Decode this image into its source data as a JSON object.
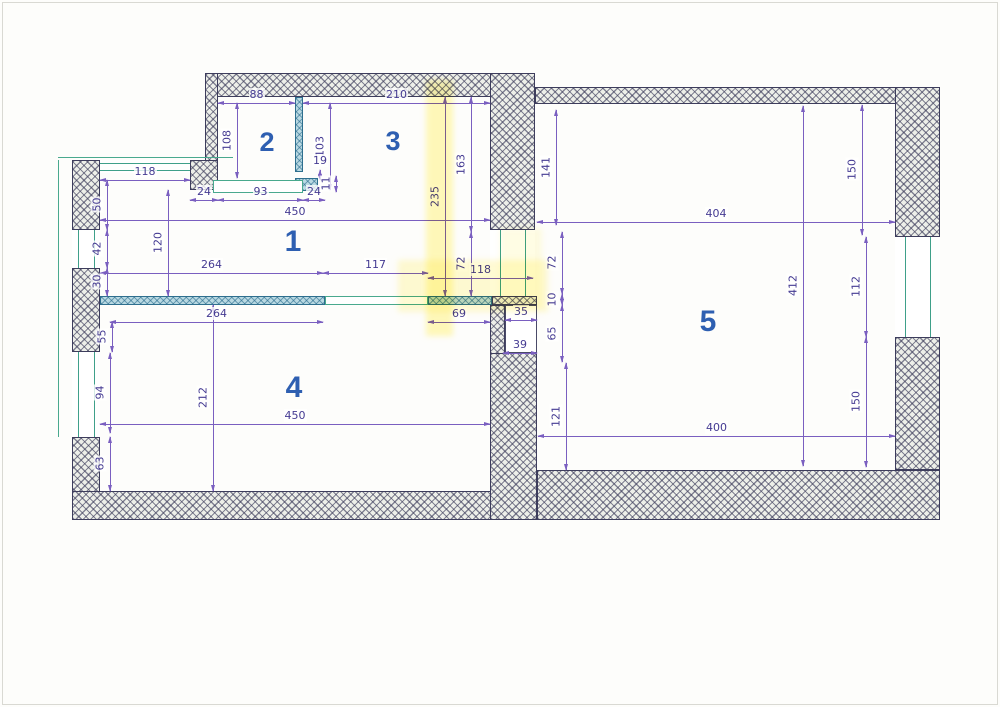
{
  "document": {
    "type": "scanned floor plan",
    "units": "cm"
  },
  "colors": {
    "page_bg": "#fdfdfb",
    "page_border": "#d9d9d3",
    "wall_hatch": "#3e3e5c",
    "wall_fill": "#edefe9",
    "partition_fill": "#b9d9e2",
    "partition_edge": "#2e6f8e",
    "window_green": "#3fa08a",
    "dim_line": "#7a5fc0",
    "dim_text": "#453b92",
    "room_number": "#2e5fb1",
    "highlighter": "#fff176"
  },
  "rooms": [
    {
      "n": "1",
      "x": 293,
      "y": 242,
      "s": 30
    },
    {
      "n": "2",
      "x": 267,
      "y": 142,
      "s": 27
    },
    {
      "n": "3",
      "x": 393,
      "y": 141,
      "s": 27
    },
    {
      "n": "4",
      "x": 294,
      "y": 388,
      "s": 30
    },
    {
      "n": "5",
      "x": 708,
      "y": 322,
      "s": 30
    }
  ],
  "walls": [
    {
      "x": 205,
      "y": 73,
      "w": 330,
      "h": 24
    },
    {
      "x": 205,
      "y": 73,
      "w": 13,
      "h": 107
    },
    {
      "x": 190,
      "y": 160,
      "w": 28,
      "h": 30
    },
    {
      "x": 490,
      "y": 73,
      "w": 45,
      "h": 157
    },
    {
      "x": 535,
      "y": 87,
      "w": 405,
      "h": 17
    },
    {
      "x": 895,
      "y": 87,
      "w": 45,
      "h": 150
    },
    {
      "x": 895,
      "y": 337,
      "w": 45,
      "h": 133
    },
    {
      "x": 537,
      "y": 470,
      "w": 403,
      "h": 50
    },
    {
      "x": 72,
      "y": 160,
      "w": 28,
      "h": 70
    },
    {
      "x": 72,
      "y": 268,
      "w": 28,
      "h": 84
    },
    {
      "x": 72,
      "y": 437,
      "w": 28,
      "h": 83
    },
    {
      "x": 72,
      "y": 491,
      "w": 465,
      "h": 29
    },
    {
      "x": 490,
      "y": 305,
      "w": 15,
      "h": 57
    },
    {
      "x": 490,
      "y": 353,
      "w": 47,
      "h": 167
    },
    {
      "x": 492,
      "y": 296,
      "w": 45,
      "h": 9
    },
    {
      "x": 295,
      "y": 97,
      "w": 8,
      "h": 75,
      "t": 1
    },
    {
      "x": 295,
      "y": 178,
      "w": 23,
      "h": 13,
      "t": 1
    },
    {
      "x": 100,
      "y": 296,
      "w": 225,
      "h": 9,
      "t": 1
    },
    {
      "x": 428,
      "y": 296,
      "w": 64,
      "h": 9,
      "t": 1
    }
  ],
  "windows": [
    {
      "x": 100,
      "y": 160,
      "w": 90,
      "h": 13,
      "k": "h"
    },
    {
      "x": 72,
      "y": 230,
      "w": 28,
      "h": 38,
      "k": "v"
    },
    {
      "x": 72,
      "y": 352,
      "w": 28,
      "h": 85,
      "k": "v"
    },
    {
      "x": 895,
      "y": 237,
      "w": 45,
      "h": 100,
      "k": "v"
    },
    {
      "x": 490,
      "y": 230,
      "w": 45,
      "h": 66,
      "k": "v"
    },
    {
      "x": 213,
      "y": 180,
      "w": 90,
      "h": 13,
      "k": "box"
    },
    {
      "x": 325,
      "y": 296,
      "w": 103,
      "h": 9,
      "k": "box"
    }
  ],
  "contours": [
    {
      "x": 58,
      "y": 160,
      "w": 1,
      "h": 277
    },
    {
      "x": 58,
      "y": 157,
      "w": 175,
      "h": 1
    }
  ],
  "niches": [
    {
      "x": 505,
      "y": 305,
      "w": 32,
      "h": 48
    }
  ],
  "highlights": [
    {
      "x": 426,
      "y": 80,
      "w": 27,
      "h": 256,
      "op": 0.5
    },
    {
      "x": 398,
      "y": 260,
      "w": 150,
      "h": 52,
      "op": 0.32
    },
    {
      "x": 500,
      "y": 228,
      "w": 42,
      "h": 80,
      "op": 0.2
    }
  ],
  "dims": [
    {
      "l": "88",
      "o": "h",
      "x": 218,
      "y": 103,
      "len": 77
    },
    {
      "l": "210",
      "o": "h",
      "x": 303,
      "y": 103,
      "len": 187
    },
    {
      "l": "118",
      "o": "h",
      "x": 100,
      "y": 180,
      "len": 90
    },
    {
      "l": "24",
      "o": "h",
      "x": 190,
      "y": 200,
      "len": 28
    },
    {
      "l": "93",
      "o": "h",
      "x": 218,
      "y": 200,
      "len": 85
    },
    {
      "l": "24",
      "o": "h",
      "x": 303,
      "y": 200,
      "len": 22
    },
    {
      "l": "450",
      "o": "h",
      "x": 100,
      "y": 220,
      "len": 390
    },
    {
      "l": "264",
      "o": "h",
      "x": 100,
      "y": 273,
      "len": 223
    },
    {
      "l": "117",
      "o": "h",
      "x": 323,
      "y": 273,
      "len": 105
    },
    {
      "l": "118",
      "o": "h",
      "x": 428,
      "y": 278,
      "len": 105
    },
    {
      "l": "404",
      "o": "h",
      "x": 537,
      "y": 222,
      "len": 358
    },
    {
      "l": "264",
      "o": "h",
      "x": 110,
      "y": 322,
      "len": 213
    },
    {
      "l": "69",
      "o": "h",
      "x": 428,
      "y": 322,
      "len": 62
    },
    {
      "l": "35",
      "o": "h",
      "x": 505,
      "y": 320,
      "len": 32
    },
    {
      "l": "39",
      "o": "h",
      "x": 503,
      "y": 353,
      "len": 34
    },
    {
      "l": "450",
      "o": "h",
      "x": 100,
      "y": 424,
      "len": 390
    },
    {
      "l": "400",
      "o": "h",
      "x": 538,
      "y": 436,
      "len": 357
    },
    {
      "l": "108",
      "o": "v",
      "x": 237,
      "y": 103,
      "len": 75
    },
    {
      "l": "103",
      "o": "v",
      "x": 330,
      "y": 103,
      "len": 87
    },
    {
      "l": "19",
      "o": "v",
      "x": 320,
      "y": 170,
      "len": 10,
      "labelH": 1
    },
    {
      "l": "11",
      "o": "v",
      "x": 336,
      "y": 176,
      "len": 16
    },
    {
      "l": "120",
      "o": "v",
      "x": 168,
      "y": 190,
      "len": 106
    },
    {
      "l": "235",
      "o": "v",
      "x": 445,
      "y": 97,
      "len": 199
    },
    {
      "l": "163",
      "o": "v",
      "x": 471,
      "y": 97,
      "len": 135
    },
    {
      "l": "141",
      "o": "v",
      "x": 556,
      "y": 110,
      "len": 115
    },
    {
      "l": "150",
      "o": "v",
      "x": 862,
      "y": 105,
      "len": 130
    },
    {
      "l": "412",
      "o": "v",
      "x": 803,
      "y": 106,
      "len": 360
    },
    {
      "l": "112",
      "o": "v",
      "x": 866,
      "y": 237,
      "len": 100
    },
    {
      "l": "150",
      "o": "v",
      "x": 866,
      "y": 337,
      "len": 130
    },
    {
      "l": "72",
      "o": "v",
      "x": 471,
      "y": 232,
      "len": 64
    },
    {
      "l": "72",
      "o": "v",
      "x": 562,
      "y": 232,
      "len": 62
    },
    {
      "l": "10",
      "o": "v",
      "x": 562,
      "y": 294,
      "len": 11
    },
    {
      "l": "65",
      "o": "v",
      "x": 562,
      "y": 305,
      "len": 57
    },
    {
      "l": "121",
      "o": "v",
      "x": 566,
      "y": 363,
      "len": 107
    },
    {
      "l": "50",
      "o": "v",
      "x": 107,
      "y": 180,
      "len": 50
    },
    {
      "l": "42",
      "o": "v",
      "x": 107,
      "y": 230,
      "len": 38
    },
    {
      "l": "30",
      "o": "v",
      "x": 107,
      "y": 268,
      "len": 28
    },
    {
      "l": "55",
      "o": "v",
      "x": 112,
      "y": 322,
      "len": 30
    },
    {
      "l": "94",
      "o": "v",
      "x": 110,
      "y": 353,
      "len": 80
    },
    {
      "l": "63",
      "o": "v",
      "x": 110,
      "y": 437,
      "len": 54
    },
    {
      "l": "212",
      "o": "v",
      "x": 213,
      "y": 305,
      "len": 186
    }
  ]
}
